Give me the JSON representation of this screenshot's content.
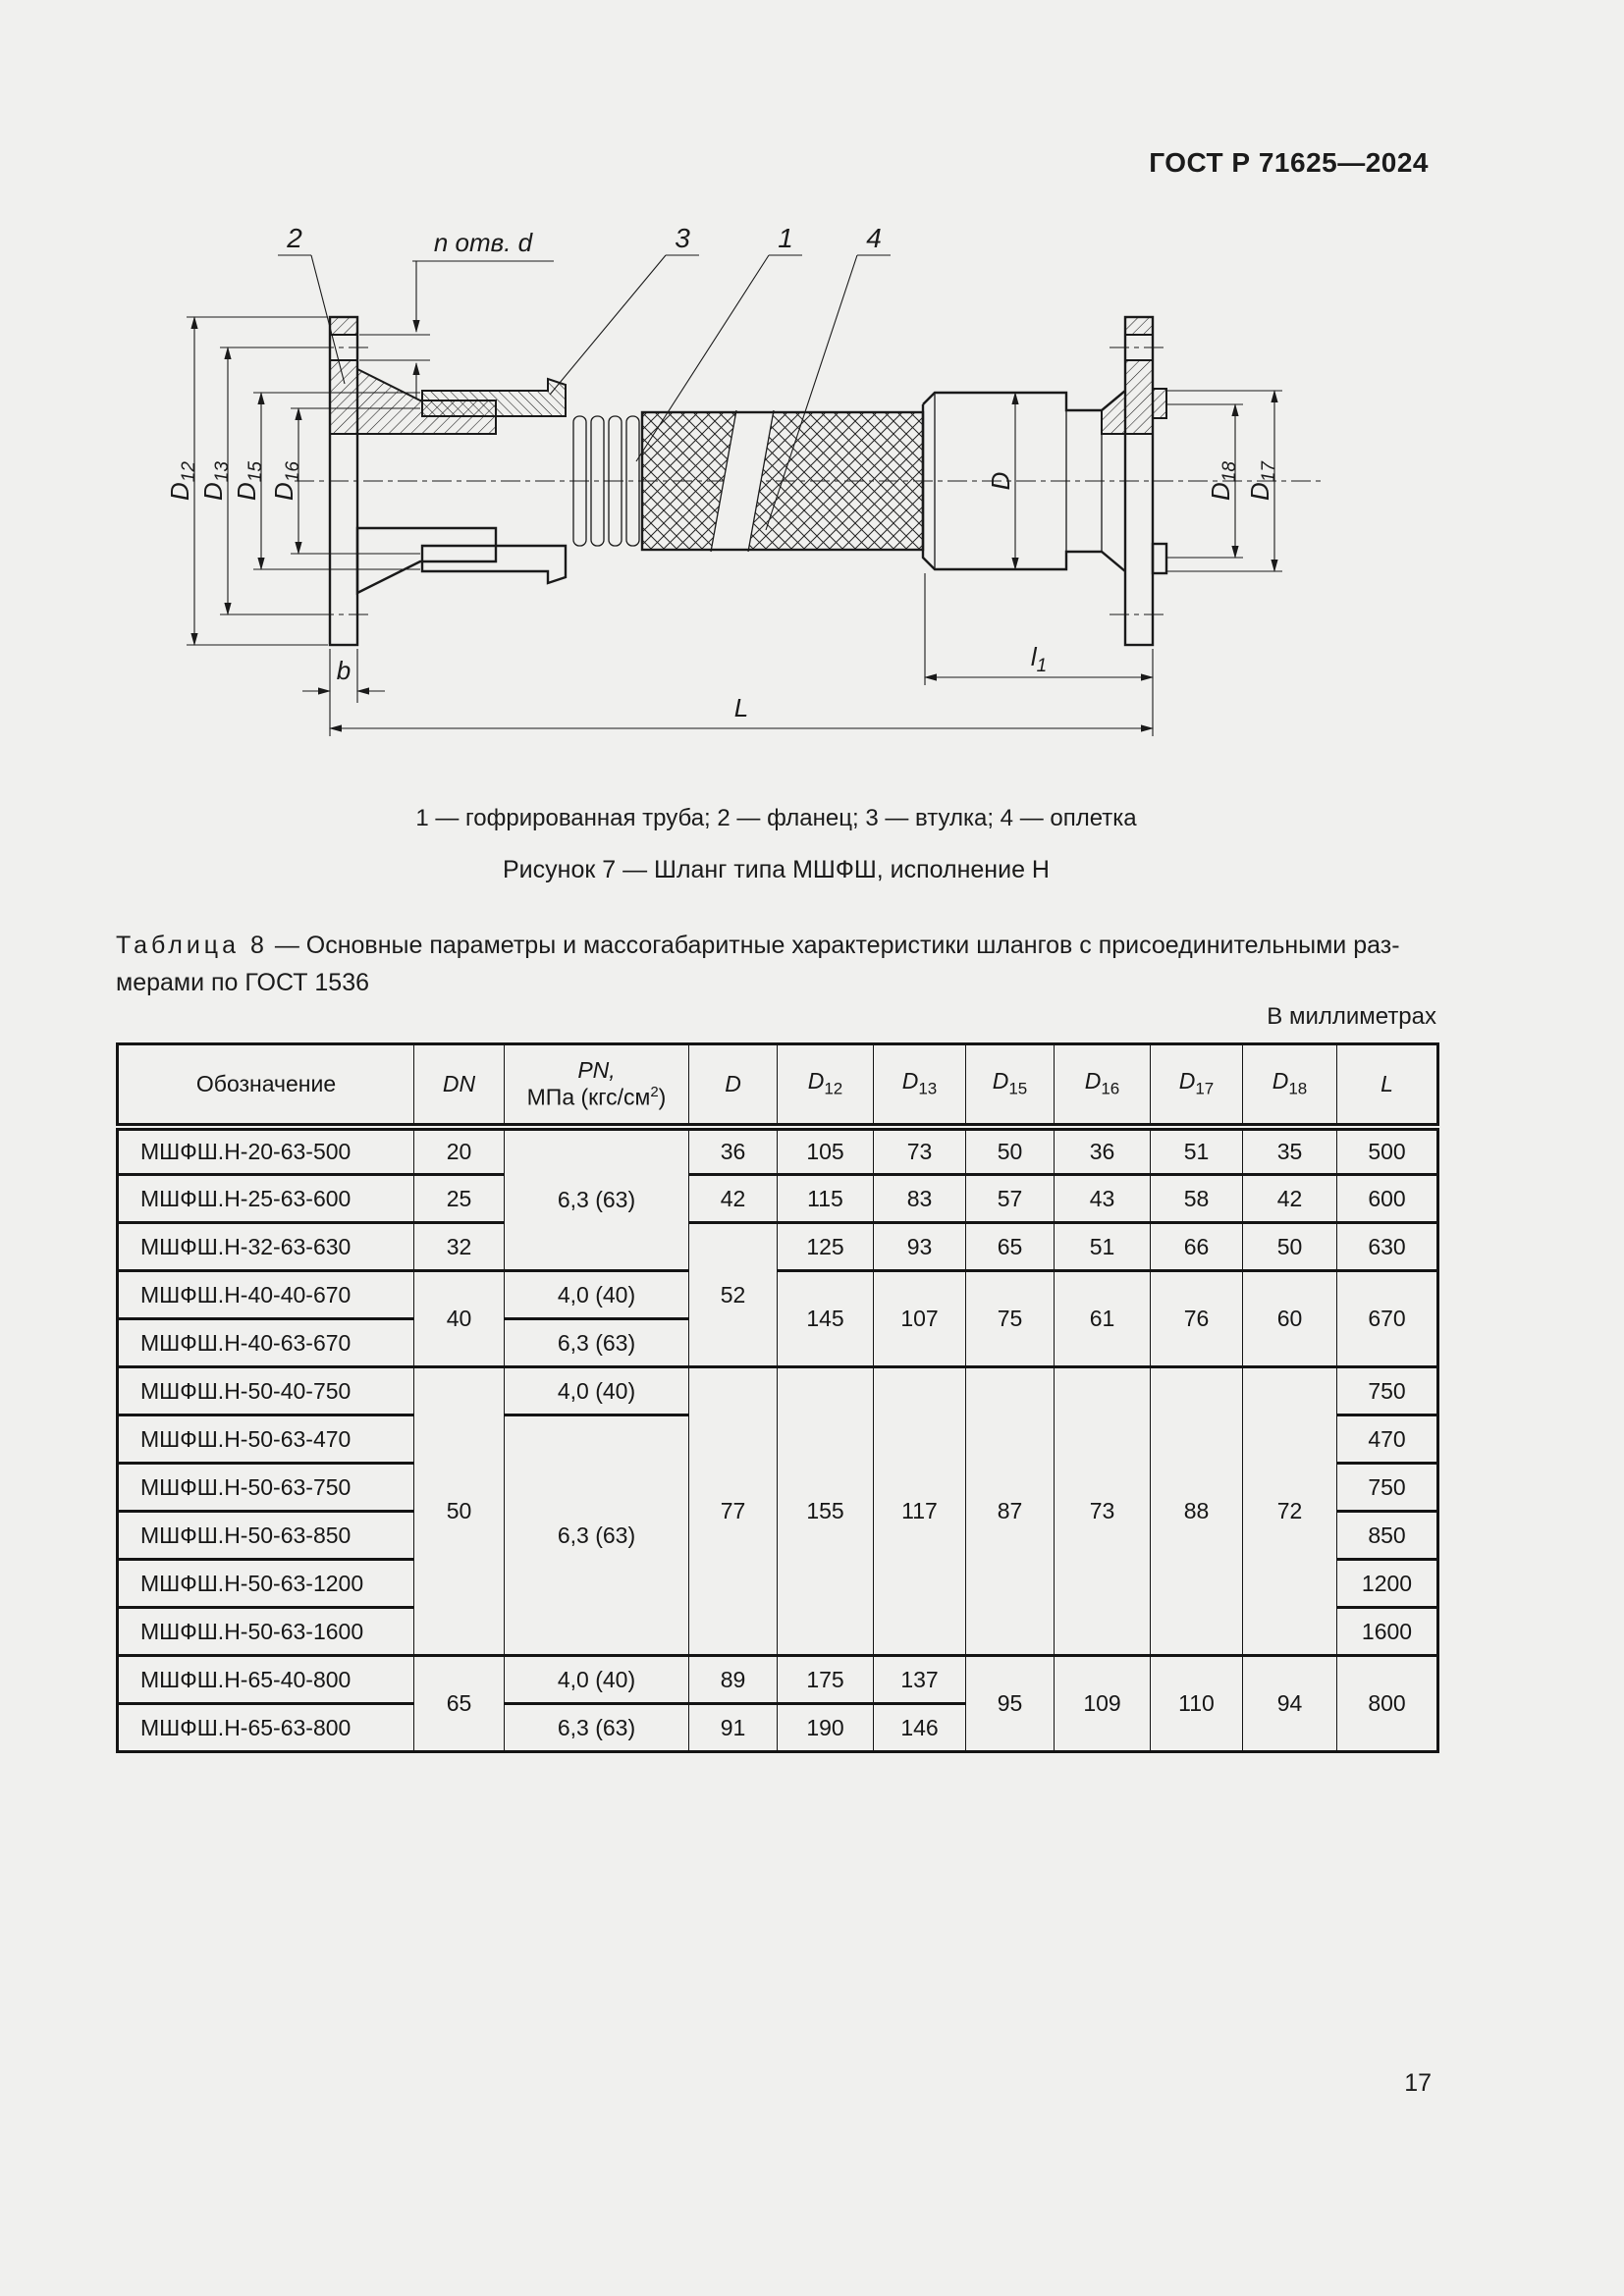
{
  "page": {
    "standard_ref": "ГОСТ Р 71625—2024",
    "page_number": "17"
  },
  "figure": {
    "caption": "1 — гофрированная труба; 2 — фланец; 3 — втулка; 4 — оплетка",
    "title": "Рисунок 7 — Шланг типа МШФШ, исполнение Н",
    "part_labels": [
      "2",
      "3",
      "1",
      "4"
    ],
    "holes_note": "n отв. d",
    "dims": {
      "d12": {
        "base": "D",
        "sub": "12"
      },
      "d13": {
        "base": "D",
        "sub": "13"
      },
      "d15": {
        "base": "D",
        "sub": "15"
      },
      "d16": {
        "base": "D",
        "sub": "16"
      },
      "d": {
        "base": "D",
        "sub": ""
      },
      "d18": {
        "base": "D",
        "sub": "18"
      },
      "d17": {
        "base": "D",
        "sub": "17"
      },
      "b": {
        "base": "b",
        "sub": ""
      },
      "l1": {
        "base": "l",
        "sub": "1"
      },
      "L": {
        "base": "L",
        "sub": ""
      }
    }
  },
  "table": {
    "title_label": "Таблица 8",
    "title_after_label": "— Основные параметры и массогабаритные характеристики шлангов с присоединительными раз-",
    "title_line2": "мерами по ГОСТ 1536",
    "units_note": "В миллиметрах",
    "headers": {
      "designation": "Обозначение",
      "dn": "DN",
      "pn_line1": "PN,",
      "pn_line2_pre": "МПа (кгс/см",
      "pn_sup": "2",
      "pn_close": ")",
      "d": "D",
      "d12": {
        "base": "D",
        "sub": "12"
      },
      "d13": {
        "base": "D",
        "sub": "13"
      },
      "d15": {
        "base": "D",
        "sub": "15"
      },
      "d16": {
        "base": "D",
        "sub": "16"
      },
      "d17": {
        "base": "D",
        "sub": "17"
      },
      "d18": {
        "base": "D",
        "sub": "18"
      },
      "l": "L"
    },
    "rows": [
      {
        "des": "МШФШ.Н-20-63-500",
        "dn": "20",
        "pn": "6,3 (63)",
        "d": "36",
        "d12": "105",
        "d13": "73",
        "d15": "50",
        "d16": "36",
        "d17": "51",
        "d18": "35",
        "l": "500"
      },
      {
        "des": "МШФШ.Н-25-63-600",
        "dn": "25",
        "d": "42",
        "d12": "115",
        "d13": "83",
        "d15": "57",
        "d16": "43",
        "d17": "58",
        "d18": "42",
        "l": "600"
      },
      {
        "des": "МШФШ.Н-32-63-630",
        "dn": "32",
        "d": "52",
        "d12": "125",
        "d13": "93",
        "d15": "65",
        "d16": "51",
        "d17": "66",
        "d18": "50",
        "l": "630"
      },
      {
        "des": "МШФШ.Н-40-40-670",
        "dn": "40",
        "pn": "4,0 (40)",
        "d12": "145",
        "d13": "107",
        "d15": "75",
        "d16": "61",
        "d17": "76",
        "d18": "60",
        "l": "670"
      },
      {
        "des": "МШФШ.Н-40-63-670",
        "pn": "6,3 (63)"
      },
      {
        "des": "МШФШ.Н-50-40-750",
        "dn": "50",
        "pn": "4,0 (40)",
        "d": "77",
        "d12": "155",
        "d13": "117",
        "d15": "87",
        "d16": "73",
        "d17": "88",
        "d18": "72",
        "l": "750"
      },
      {
        "des": "МШФШ.Н-50-63-470",
        "pn": "6,3 (63)",
        "l": "470"
      },
      {
        "des": "МШФШ.Н-50-63-750",
        "l": "750"
      },
      {
        "des": "МШФШ.Н-50-63-850",
        "l": "850"
      },
      {
        "des": "МШФШ.Н-50-63-1200",
        "l": "1200"
      },
      {
        "des": "МШФШ.Н-50-63-1600",
        "l": "1600"
      },
      {
        "des": "МШФШ.Н-65-40-800",
        "dn": "65",
        "pn": "4,0 (40)",
        "d": "89",
        "d12": "175",
        "d13": "137",
        "d15": "95",
        "d16": "109",
        "d17": "110",
        "d18": "94",
        "l": "800"
      },
      {
        "des": "МШФШ.Н-65-63-800",
        "pn": "6,3 (63)",
        "d": "91",
        "d12": "190",
        "d13": "146"
      }
    ]
  }
}
